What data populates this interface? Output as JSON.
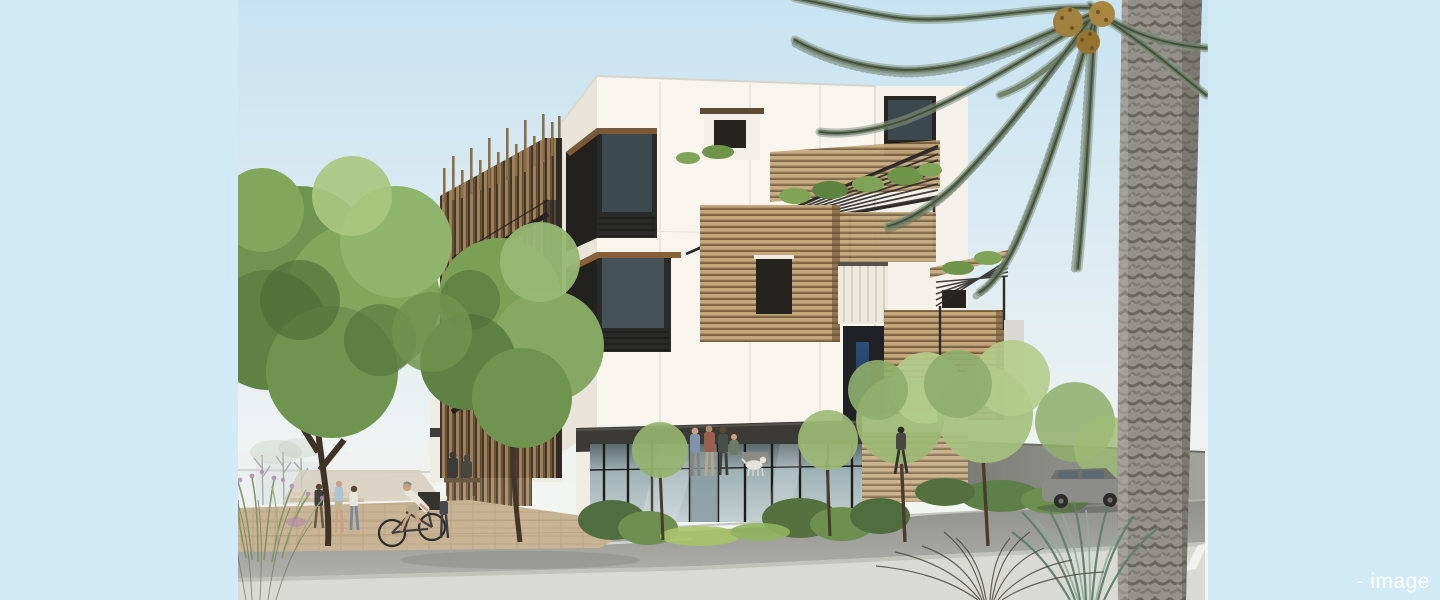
{
  "caption": {
    "text": "- image"
  },
  "palette": {
    "band": "#d0ebf5",
    "caption": "#ffffff",
    "sky_top": "#c7e3f2",
    "sky_low": "#f3f5f1",
    "white_wall": "#f8f5ef",
    "wall_shade": "#e8e4da",
    "wood_slat": "#b3926a",
    "dark_frame": "#26241f",
    "pergola_steel": "#2c2b28",
    "foliage_mid": "#7aa05a",
    "palm_frond": "#68785f",
    "palm_trunk": "#94908a",
    "asphalt": "#9a9a96",
    "crosswalk": "#d9dad3",
    "brick_path": "#c9b496",
    "glass_blue": "#2b4f79",
    "car_gray": "#8c8d89"
  }
}
